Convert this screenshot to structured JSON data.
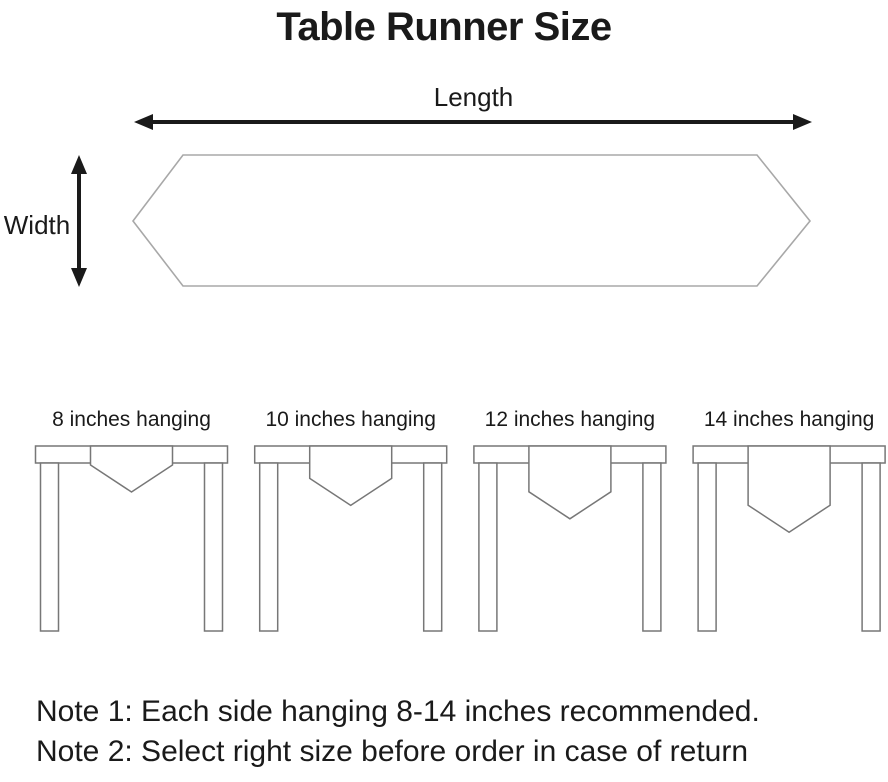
{
  "title": "Table Runner Size",
  "diagram": {
    "length_label": "Length",
    "width_label": "Width"
  },
  "hanging_options": [
    {
      "inches": 8,
      "label": "8 inches hanging"
    },
    {
      "inches": 10,
      "label": "10 inches hanging"
    },
    {
      "inches": 12,
      "label": "12 inches hanging"
    },
    {
      "inches": 14,
      "label": "14 inches hanging"
    }
  ],
  "notes": [
    {
      "text": "Note 1: Each side hanging 8-14 inches recommended."
    },
    {
      "text": "Note 2: Select right size before order in case of return"
    }
  ],
  "colors": {
    "text": "#1a1a1a",
    "arrow": "#1a1a1a",
    "table_outline": "#777777",
    "runner_outline": "#a8a8a8",
    "background": "#ffffff"
  }
}
